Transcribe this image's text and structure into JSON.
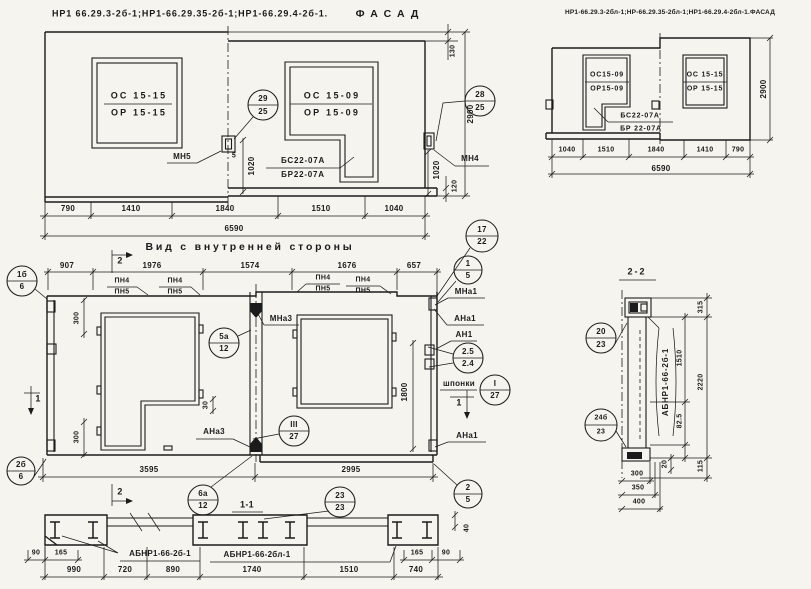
{
  "facade_left": {
    "title_codes": "НР1 66.29.3-2б-1;НР1-66.29.35-2б-1;НР1-66.29.4-2б-1.",
    "title_type": "ФАСАД",
    "window1_line1": "ОС 15-15",
    "window1_line2": "ОР 15-15",
    "window2_line1": "ОС 15-09",
    "window2_line2": "ОР 15-09",
    "sill_line1": "БС22-07А",
    "sill_line2": "БР22-07А",
    "anchor_left": "МН5",
    "anchor_right": "МН4",
    "anchor_dim": "5",
    "callout_joint_top": "29",
    "callout_joint_bottom": "25",
    "callout_edge_top": "28",
    "callout_edge_bottom": "25",
    "dims_row1": [
      "790",
      "1410",
      "1840",
      "1510",
      "1040"
    ],
    "dim_total": "6590",
    "dim_height": "2900",
    "dim_step_top": "130",
    "dim_step_bottom": "120",
    "dim_sill_left": "1020",
    "dim_sill_right": "1020"
  },
  "facade_right": {
    "title": "НР1-66.29.3-2бл-1;НР-66.29.35-2бл-1;НР1-66.29.4-2бл-1.ФАСАД",
    "window1_line1": "ОС15-09",
    "window1_line2": "ОР15-09",
    "window2_line1": "ОС 15-15",
    "window2_line2": "ОР 15-15",
    "sill_line1": "БС22-07А",
    "sill_line2": "БР 22-07А",
    "dims_row1": [
      "1040",
      "1510",
      "1840",
      "1410",
      "790"
    ],
    "dim_total": "6590",
    "dim_height": "2900"
  },
  "inner_view": {
    "title": "Вид с внутренней стороны",
    "dims_top": [
      "907",
      "1976",
      "1574",
      "1676",
      "657"
    ],
    "pn_top": "ПН4",
    "pn_bottom": "ПН5",
    "label_mna3": "МНа3",
    "label_ana3": "АНа3",
    "label_mna1": "МНа1",
    "label_ana1": "АНа1",
    "label_an1": "АН1",
    "label_ana1_b": "АНа1",
    "label_shponki": "шпонки",
    "callout_1b6_top": "1б",
    "callout_1b6_bottom": "6",
    "callout_2b6_top": "2б",
    "callout_2b6_bottom": "6",
    "callout_5a12_top": "5а",
    "callout_5a12_bottom": "12",
    "callout_iii27_top": "III",
    "callout_iii27_bottom": "27",
    "callout_17_22_top": "17",
    "callout_17_22_bottom": "22",
    "callout_1_5_top": "1",
    "callout_1_5_bottom": "5",
    "callout_25_24_top": "2.5",
    "callout_25_24_bottom": "2.4",
    "callout_i27_top": "I",
    "callout_i27_bottom": "27",
    "callout_6a12_top": "6а",
    "callout_6a12_bottom": "12",
    "callout_23_23_top": "23",
    "callout_23_23_bottom": "23",
    "callout_2_5_top": "2",
    "callout_2_5_bottom": "5",
    "section1_label": "1",
    "section2_label": "2",
    "dim_300_top": "300",
    "dim_300_bottom": "300",
    "dim_30": "30",
    "dim_1800": "1800",
    "dim_3595": "3595",
    "dim_2995": "2995"
  },
  "section_1_1": {
    "title": "1-1",
    "label_left": "АБНР1-66-2б-1",
    "label_right": "АБНР1-66-2бл-1",
    "dims_left": [
      "90",
      "165"
    ],
    "dims_right": [
      "165",
      "90"
    ],
    "dim_plate": "40",
    "dims_bottom": [
      "990",
      "720",
      "890",
      "1740",
      "1510",
      "740"
    ]
  },
  "section_2_2": {
    "title": "2-2",
    "label": "АБНР1-66-2б-1",
    "callout_top_top": "20",
    "callout_top_bottom": "23",
    "callout_bot_top": "24б",
    "callout_bot_bottom": "23",
    "dim_315": "315",
    "dim_1510": "1510",
    "dim_2220": "2220",
    "dim_825": "82.5",
    "dim_20": "20",
    "dim_115": "115",
    "dims_bottom": [
      "300",
      "350",
      "400"
    ]
  }
}
